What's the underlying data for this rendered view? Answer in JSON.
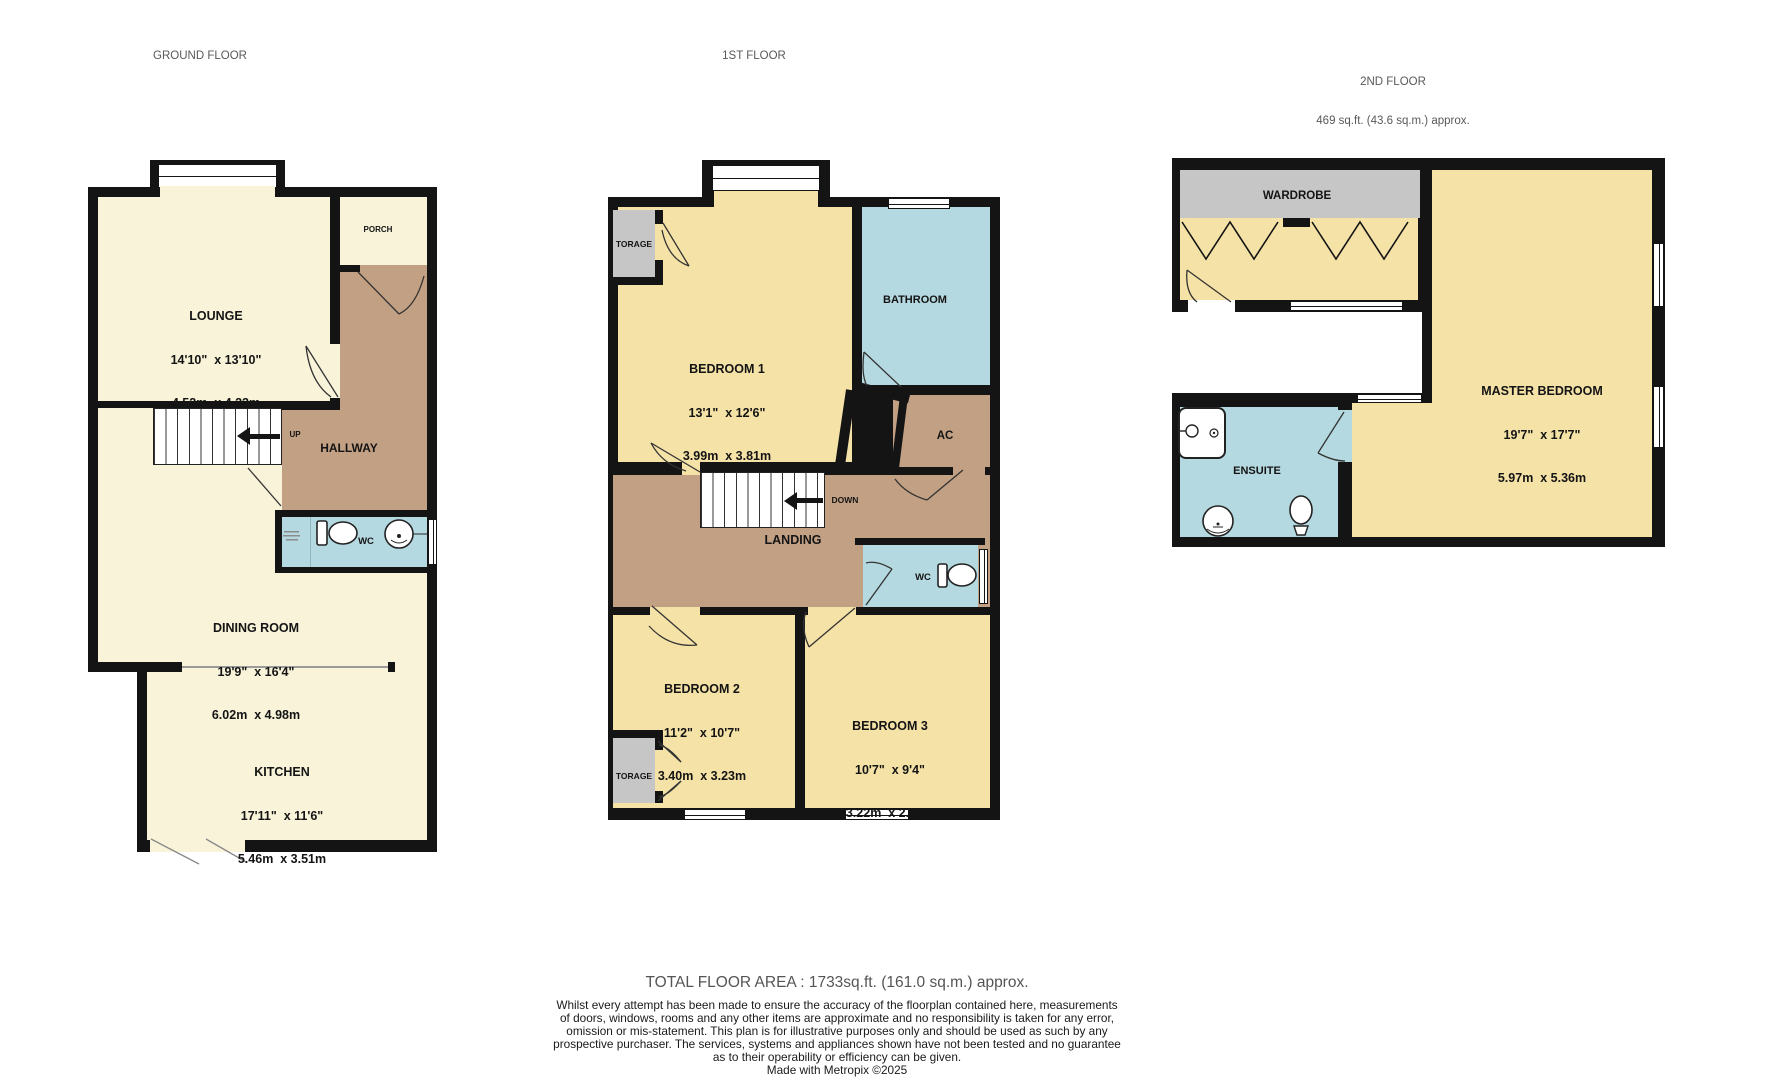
{
  "headers": {
    "ground": "GROUND FLOOR",
    "first": "1ST FLOOR",
    "second": "2ND FLOOR",
    "second_area": "469 sq.ft. (43.6 sq.m.) approx."
  },
  "ground": {
    "lounge": {
      "name": "LOUNGE",
      "imperial": "14'10\"  x 13'10\"",
      "metric": "4.52m  x 4.22m"
    },
    "porch": "PORCH",
    "hallway": "HALLWAY",
    "up": "UP",
    "wc": "WC",
    "dining": {
      "name": "DINING ROOM",
      "imperial": "19'9\"  x 16'4\"",
      "metric": "6.02m  x 4.98m"
    },
    "kitchen": {
      "name": "KITCHEN",
      "imperial": "17'11\"  x 11'6\"",
      "metric": "5.46m  x 3.51m"
    }
  },
  "first": {
    "storage_top": "TORAGE",
    "bedroom1": {
      "name": "BEDROOM 1",
      "imperial": "13'1\"  x 12'6\"",
      "metric": "3.99m  x 3.81m"
    },
    "bathroom": "BATHROOM",
    "ac": "AC",
    "down": "DOWN",
    "landing": "LANDING",
    "wc": "WC",
    "bedroom2": {
      "name": "BEDROOM 2",
      "imperial": "11'2\"  x 10'7\"",
      "metric": "3.40m  x 3.23m"
    },
    "bedroom3": {
      "name": "BEDROOM 3",
      "imperial": "10'7\"  x 9'4\"",
      "metric": "3.22m  x 2.84m"
    },
    "storage_bottom": "TORAGE"
  },
  "second": {
    "wardrobe": "WARDROBE",
    "master": {
      "name": "MASTER BEDROOM",
      "imperial": "19'7\"  x 17'7\"",
      "metric": "5.97m  x 5.36m"
    },
    "ensuite": "ENSUITE"
  },
  "footer": {
    "total": "TOTAL FLOOR AREA : 1733sq.ft. (161.0 sq.m.) approx.",
    "disclaimer": [
      "Whilst every attempt has been made to ensure the accuracy of the floorplan contained here, measurements",
      "of doors, windows, rooms and any other items are approximate and no responsibility is taken for any error,",
      "omission or mis-statement. This plan is for illustrative purposes only and should be used as such by any",
      "prospective purchaser. The services, systems and appliances shown have not been tested and no guarantee",
      "as to their operability or efficiency can be given.",
      "Made with Metropix ©2025"
    ]
  },
  "colors": {
    "wall": "#141414",
    "room_cream": "#f8f3d9",
    "room_gold": "#f5e2a7",
    "hall_brown": "#c2a083",
    "bath_blue": "#b5d9e0",
    "storage_gray": "#c6c6c7"
  }
}
